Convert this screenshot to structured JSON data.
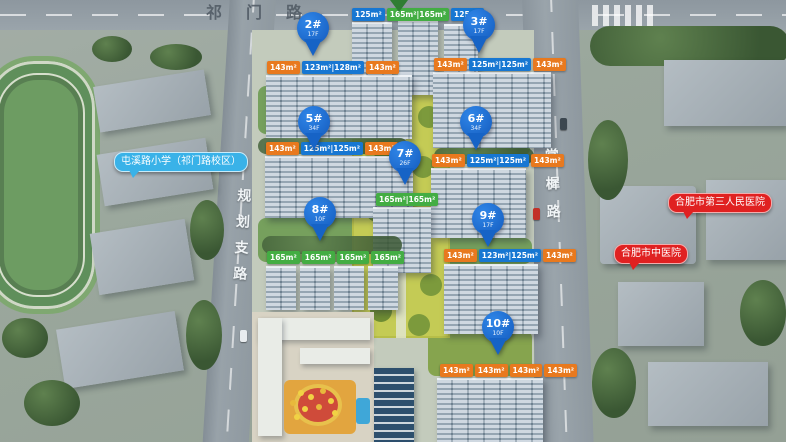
{
  "roads": {
    "top": "祁门路",
    "left": "规划支路",
    "right": "棠樨路"
  },
  "landmarks": {
    "school": "屯溪路小学（祁门路校区）",
    "hospital_1": "合肥市第三人民医院",
    "hospital_2": "合肥市中医院"
  },
  "pins": {
    "p2": {
      "label": "2#",
      "sub": "17F"
    },
    "p3": {
      "label": "3#",
      "sub": "17F"
    },
    "p5": {
      "label": "5#",
      "sub": "34F"
    },
    "p6": {
      "label": "6#",
      "sub": "34F"
    },
    "p7": {
      "label": "7#",
      "sub": "26F"
    },
    "p8": {
      "label": "8#",
      "sub": "10F"
    },
    "p9": {
      "label": "9#",
      "sub": "17F"
    },
    "p10": {
      "label": "10#",
      "sub": "10F"
    }
  },
  "areas": {
    "b1": {
      "tags": [
        {
          "v": "125m²"
        },
        {
          "v": "165m²|165m²"
        },
        {
          "v": "125m²"
        }
      ]
    },
    "b2": {
      "tags": [
        {
          "v": "143m²"
        },
        {
          "v": "123m²|128m²"
        },
        {
          "v": "143m²"
        }
      ]
    },
    "b3": {
      "tags": [
        {
          "v": "143m²"
        },
        {
          "v": "125m²|125m²"
        },
        {
          "v": "143m²"
        }
      ]
    },
    "b5": {
      "tags": [
        {
          "v": "143m²"
        },
        {
          "v": "125m²|125m²"
        },
        {
          "v": "143m²"
        }
      ]
    },
    "b6": {
      "tags": [
        {
          "v": "143m²"
        },
        {
          "v": "125m²|125m²"
        },
        {
          "v": "143m²"
        }
      ]
    },
    "b7": {
      "tags": [
        {
          "v": "165m²|165m²"
        }
      ]
    },
    "b8": {
      "tags": [
        {
          "v": "165m²"
        },
        {
          "v": "165m²"
        },
        {
          "v": "165m²"
        },
        {
          "v": "165m²"
        }
      ]
    },
    "b9": {
      "tags": [
        {
          "v": "143m²"
        },
        {
          "v": "123m²|125m²"
        },
        {
          "v": "143m²"
        }
      ]
    },
    "b10": {
      "tags": [
        {
          "v": "143m²"
        },
        {
          "v": "143m²"
        },
        {
          "v": "143m²"
        },
        {
          "v": "143m²"
        }
      ]
    }
  },
  "colors": {
    "pin_blue": "#1663c6",
    "tag_blue": "#1777d2",
    "tag_orange": "#e8791e",
    "tag_green": "#43ad43",
    "school_bubble": "#39b2e8",
    "hospital_bubble": "#e02121"
  }
}
